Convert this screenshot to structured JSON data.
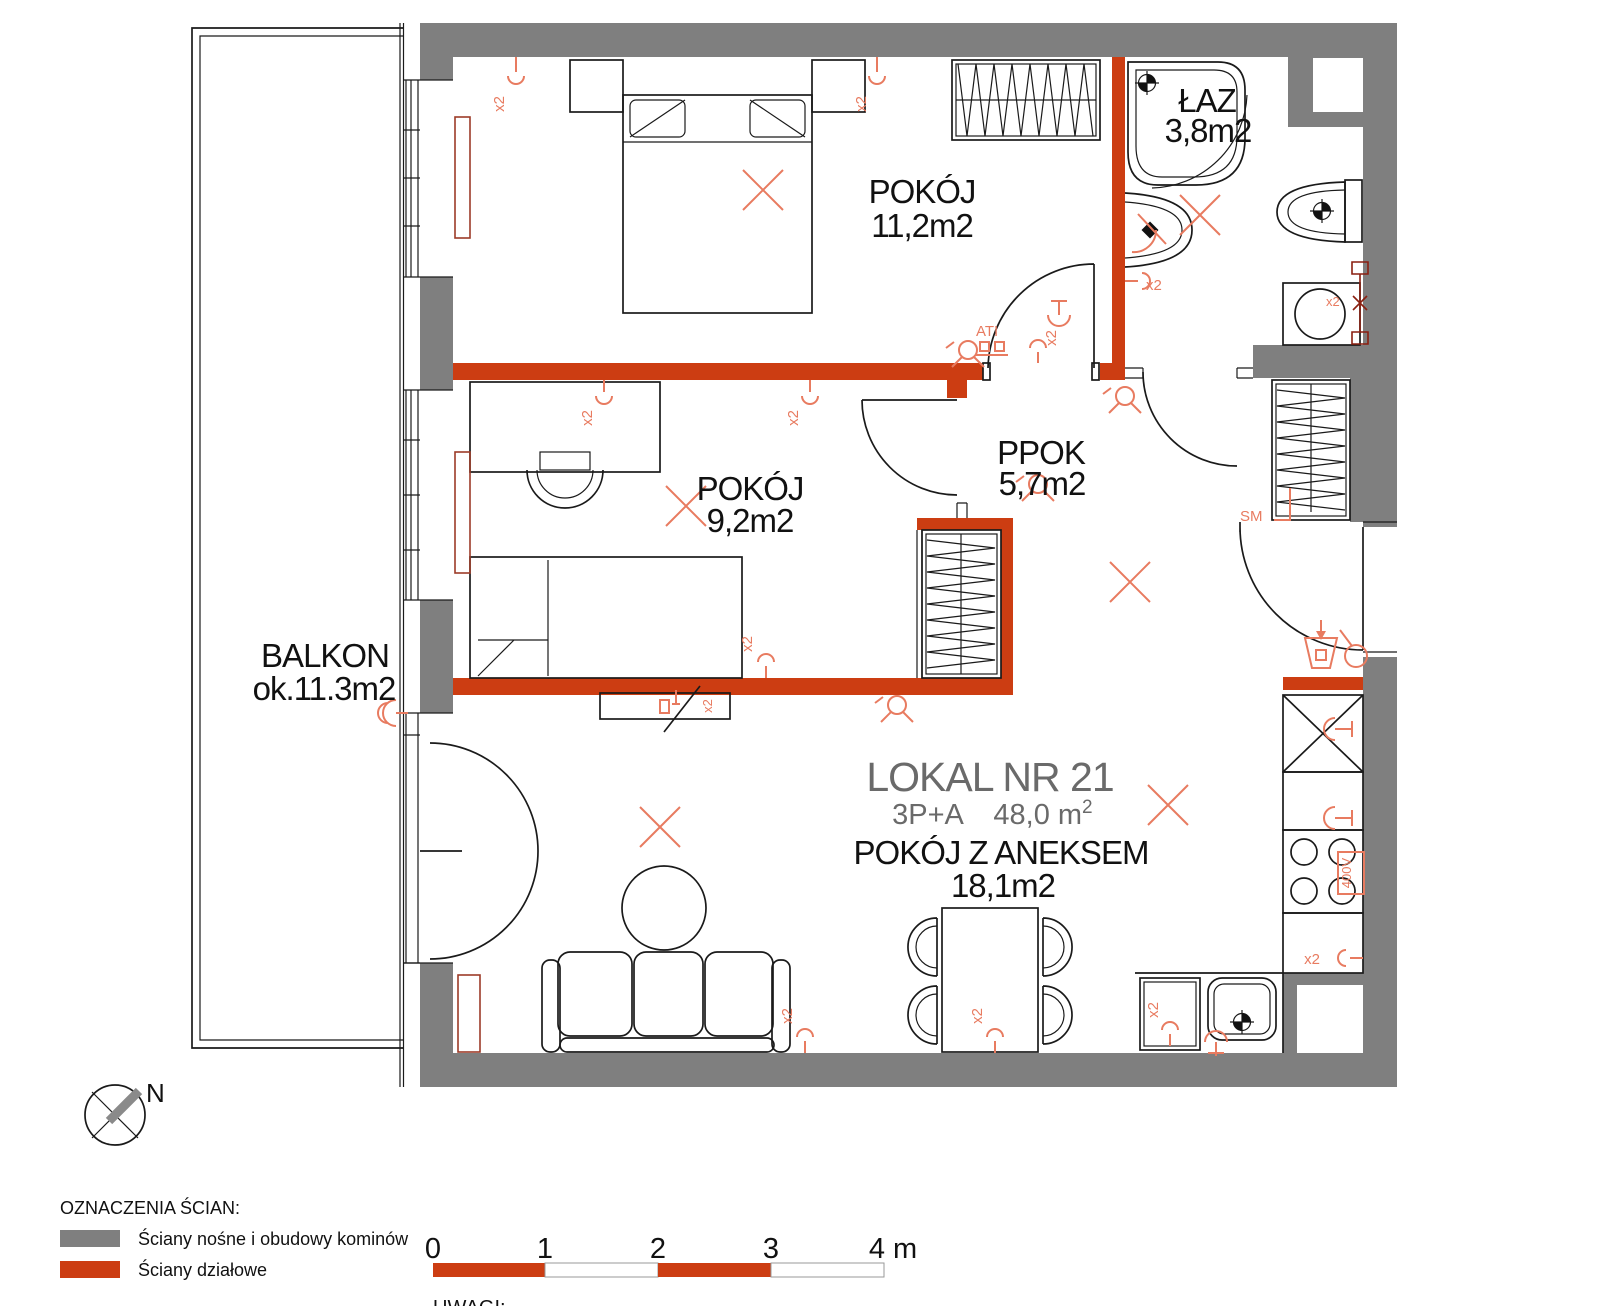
{
  "plan": {
    "unit": {
      "title": "LOKAL NR 21",
      "type": "3P+A",
      "area": "48,0 m",
      "area_sup": "2"
    },
    "rooms": {
      "bedroom": {
        "name": "POKÓJ",
        "area": "11,2m2"
      },
      "bathroom": {
        "name": "ŁAZ",
        "area": "3,8m2"
      },
      "room2": {
        "name": "POKÓJ",
        "area": "9,2m2"
      },
      "hall": {
        "name": "PPOK",
        "area": "5,7m2"
      },
      "living": {
        "name": "POKÓJ Z ANEKSEM",
        "area": "18,1m2"
      },
      "balcony": {
        "name": "BALKON",
        "area": "ok.11.3m2"
      }
    },
    "marks": {
      "socket": "x2",
      "ati": "ATI",
      "sm": "SM",
      "power": "400V"
    },
    "compass": {
      "north": "N"
    }
  },
  "legend": {
    "title": "OZNACZENIA ŚCIAN:",
    "items": [
      {
        "label": "Ściany nośne i obudowy kominów",
        "color": "#7f7f7f"
      },
      {
        "label": "Ściany działowe",
        "color": "#cc3d12"
      }
    ]
  },
  "scale_bar": {
    "ticks": [
      "0",
      "1",
      "2",
      "3"
    ],
    "end": "4 m"
  },
  "notes": {
    "label": "UWAGI:"
  },
  "colors": {
    "load_bearing_wall": "#7f7f7f",
    "partition_wall": "#cc3d12",
    "electric_symbols": "#e87b60",
    "drawing_lines": "#1a1a1a"
  }
}
